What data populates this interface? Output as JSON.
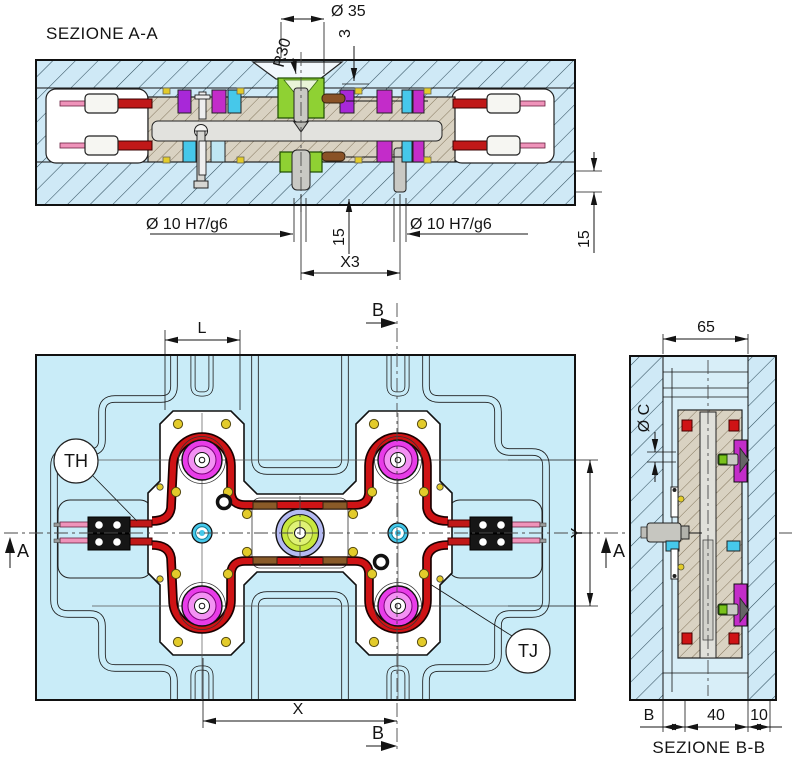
{
  "labels": {
    "section_aa_title": "SEZIONE A-A",
    "section_bb_title": "SEZIONE B-B",
    "dim_dia35": "Ø 35",
    "dim_r30": "R30",
    "dim_3": "3",
    "dim_dia10_left": "Ø 10 H7/g6",
    "dim_dia10_right": "Ø 10 H7/g6",
    "dim_15_mid": "15",
    "dim_x3": "X3",
    "dim_15_right": "15",
    "dim_L": "L",
    "dim_X": "X",
    "dim_Y": "Y",
    "dim_65": "65",
    "dim_diaC": "Ø C",
    "dim_B_seg": "B",
    "dim_40": "40",
    "dim_10": "10",
    "balloon_th": "TH",
    "balloon_tj": "TJ",
    "marker_a_left": "A",
    "marker_a_right": "A",
    "marker_b_top": "B",
    "marker_b_bottom": "B"
  },
  "colors": {
    "plate_blue": "#cfe9f6",
    "plan_cyan": "#c9ecf8",
    "core_tan": "#d9d2c2",
    "seal_red": "#cf1315",
    "boss_magenta": "#e83ce8",
    "boss_pink": "#f391f3",
    "sprue_green": "#c8e83e",
    "sprue_lavender": "#b4baf2",
    "bushing_green": "#8fd133",
    "accent_purple": "#a828d8",
    "accent_magenta": "#c32cc9",
    "accent_cyan": "#46c8ea",
    "accent_yellow": "#e3cb2a",
    "wire_red": "#c01818",
    "pin_pink": "#ef93ba",
    "metal_gray": "#c9c9c4"
  }
}
